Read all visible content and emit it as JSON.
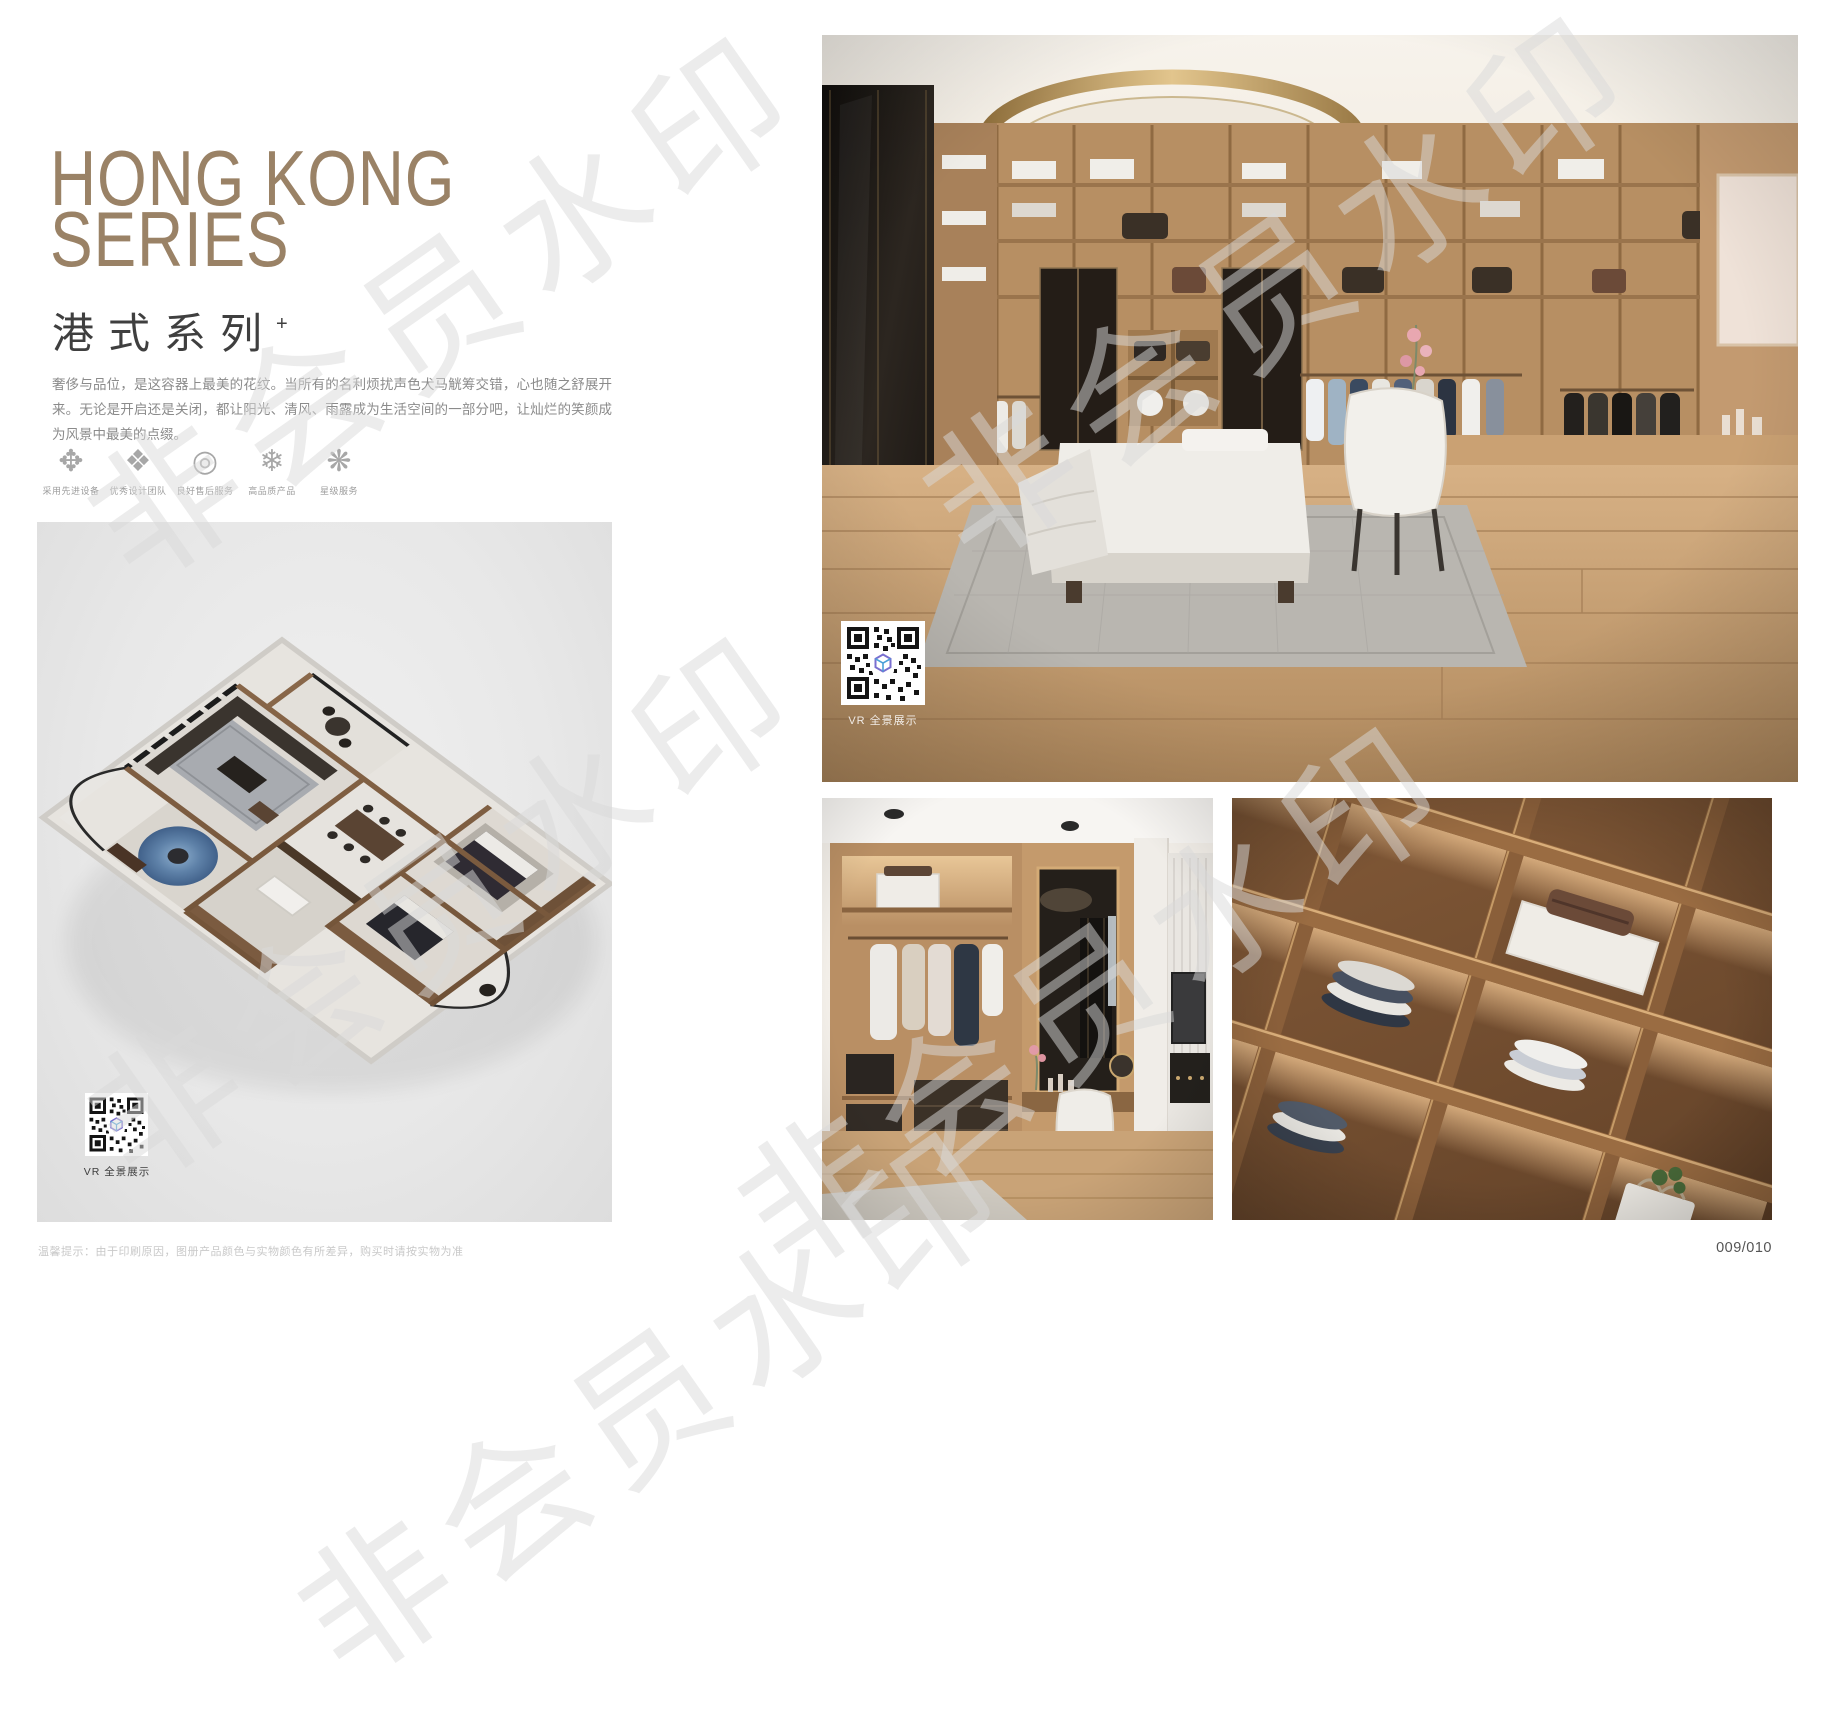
{
  "header": {
    "title_en_line1": "HONG KONG",
    "title_en_line2": "SERIES",
    "title_cn": "港式系列",
    "title_mark": "+"
  },
  "intro": "奢侈与品位，是这容器上最美的花纹。当所有的名利烦扰声色犬马觥筹交错，心也随之舒展开来。无论是开启还是关闭，都让阳光、清风、雨露成为生活空间的一部分吧，让灿烂的笑颜成为风景中最美的点缀。",
  "features": [
    {
      "icon": "pinwheel-icon",
      "glyph": "✥",
      "label": "采用先进设备"
    },
    {
      "icon": "diamond-lattice-icon",
      "glyph": "❖",
      "label": "优秀设计团队"
    },
    {
      "icon": "ring-swirl-icon",
      "glyph": "◎",
      "label": "良好售后服务"
    },
    {
      "icon": "snowflake-icon",
      "glyph": "❄",
      "label": "高品质产品"
    },
    {
      "icon": "star-ornament-icon",
      "glyph": "❋",
      "label": "星级服务"
    }
  ],
  "vr": {
    "label": "VR 全景展示"
  },
  "footer": {
    "note": "温馨提示：由于印刷原因，图册产品颜色与实物颜色有所差异，购买时请按实物为准",
    "page_number": "009/010"
  },
  "watermark": {
    "text": "非会员水印"
  },
  "colors": {
    "accent_bronze": "#9a8266",
    "subtitle_gray": "#3f3f3f",
    "body_gray": "#8b8b8b",
    "panel_gray": "#e9e9e9",
    "wood": "#b78f63",
    "dark_cabinet": "#1d1914"
  }
}
